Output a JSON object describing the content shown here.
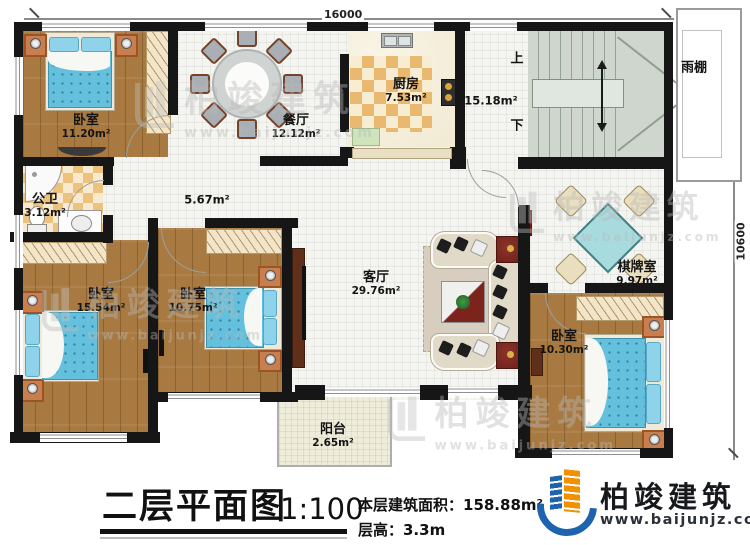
{
  "plan": {
    "dimensions": {
      "width": "16000",
      "height": "10600"
    },
    "rooms": {
      "bedroom_top_left": {
        "label": "卧室",
        "area": "11.20m²"
      },
      "dining": {
        "label": "餐厅",
        "area": "12.12m²"
      },
      "kitchen": {
        "label": "厨房",
        "area": "7.53m²"
      },
      "stair_hall": {
        "area": "15.18m²"
      },
      "stairs": {
        "up": "上",
        "down": "下"
      },
      "canopy": {
        "label": "雨棚"
      },
      "bathroom": {
        "label": "公卫",
        "area": "3.12m²"
      },
      "corridor": {
        "area": "5.67m²"
      },
      "living": {
        "label": "客厅",
        "area": "29.76m²"
      },
      "chess": {
        "label": "棋牌室",
        "area": "9.97m²"
      },
      "bedroom_bottom_left": {
        "label": "卧室",
        "area": "15.54m²"
      },
      "bedroom_bottom_mid": {
        "label": "卧室",
        "area": "10.75m²"
      },
      "bedroom_bottom_right": {
        "label": "卧室",
        "area": "10.30m²"
      },
      "balcony": {
        "label": "阳台",
        "area": "2.65m²"
      }
    }
  },
  "title_block": {
    "title": "二层平面图",
    "scale": "1:100",
    "floor_area": "本层建筑面积：158.88m²",
    "floor_height": "层高：3.3m"
  },
  "branding": {
    "company": "柏竣建筑",
    "website": "www.baijunjz.com"
  },
  "watermark": {
    "company": "柏竣建筑",
    "website": "www.baijunjz.com"
  }
}
